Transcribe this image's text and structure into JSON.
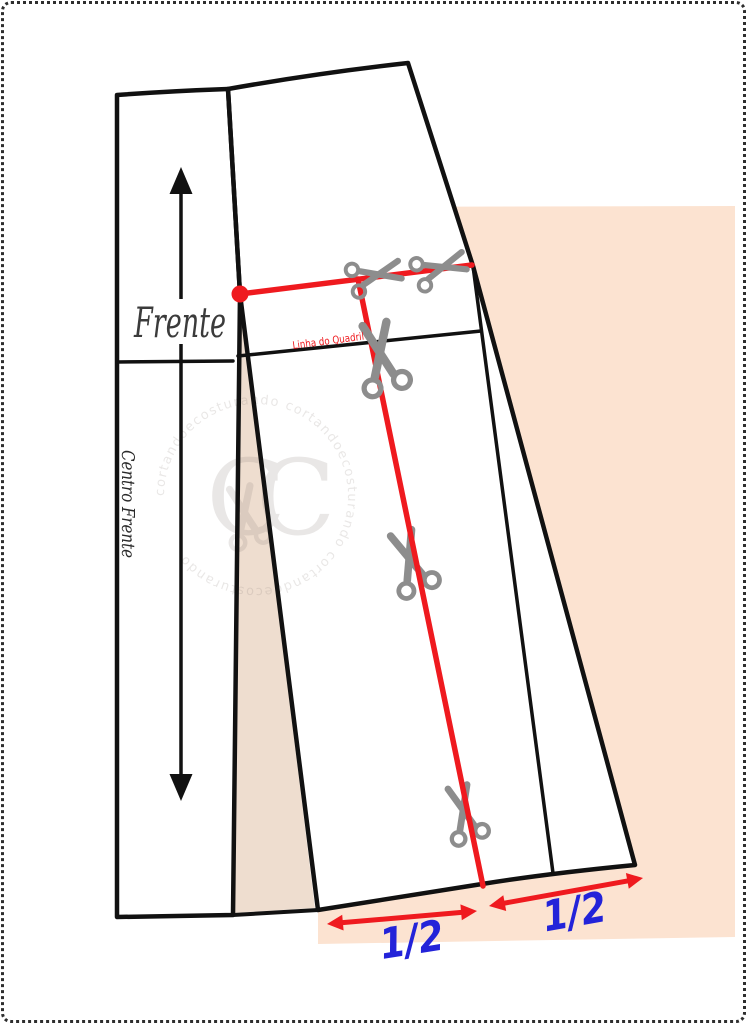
{
  "page": {
    "background": "#ffffff",
    "border_color": "#2e2e2e"
  },
  "colors": {
    "black": "#111111",
    "red": "#ef1a1f",
    "blue": "#2323d9",
    "peach_rect": "#fce3d1",
    "peach_triangle": "#eeddcf",
    "scissors_gray": "#8d8d8d",
    "label_dark": "#3b3b3b",
    "center_front_dark": "#2a2a2a",
    "watermark_gray": "#8a7f78"
  },
  "labels": {
    "front": "Frente",
    "center_front": "Centro Frente",
    "hip_line": "Linha do Quadril",
    "hem_half_left": "1/2",
    "hem_half_right": "1/2"
  },
  "watermark": {
    "monogram": "CC",
    "ring_text": "cortandoecosturando cortandoecosturando cortandoecosturando"
  },
  "icons": {
    "scissors": "scissors-icon",
    "grainline": "grainline-double-arrow-icon"
  }
}
